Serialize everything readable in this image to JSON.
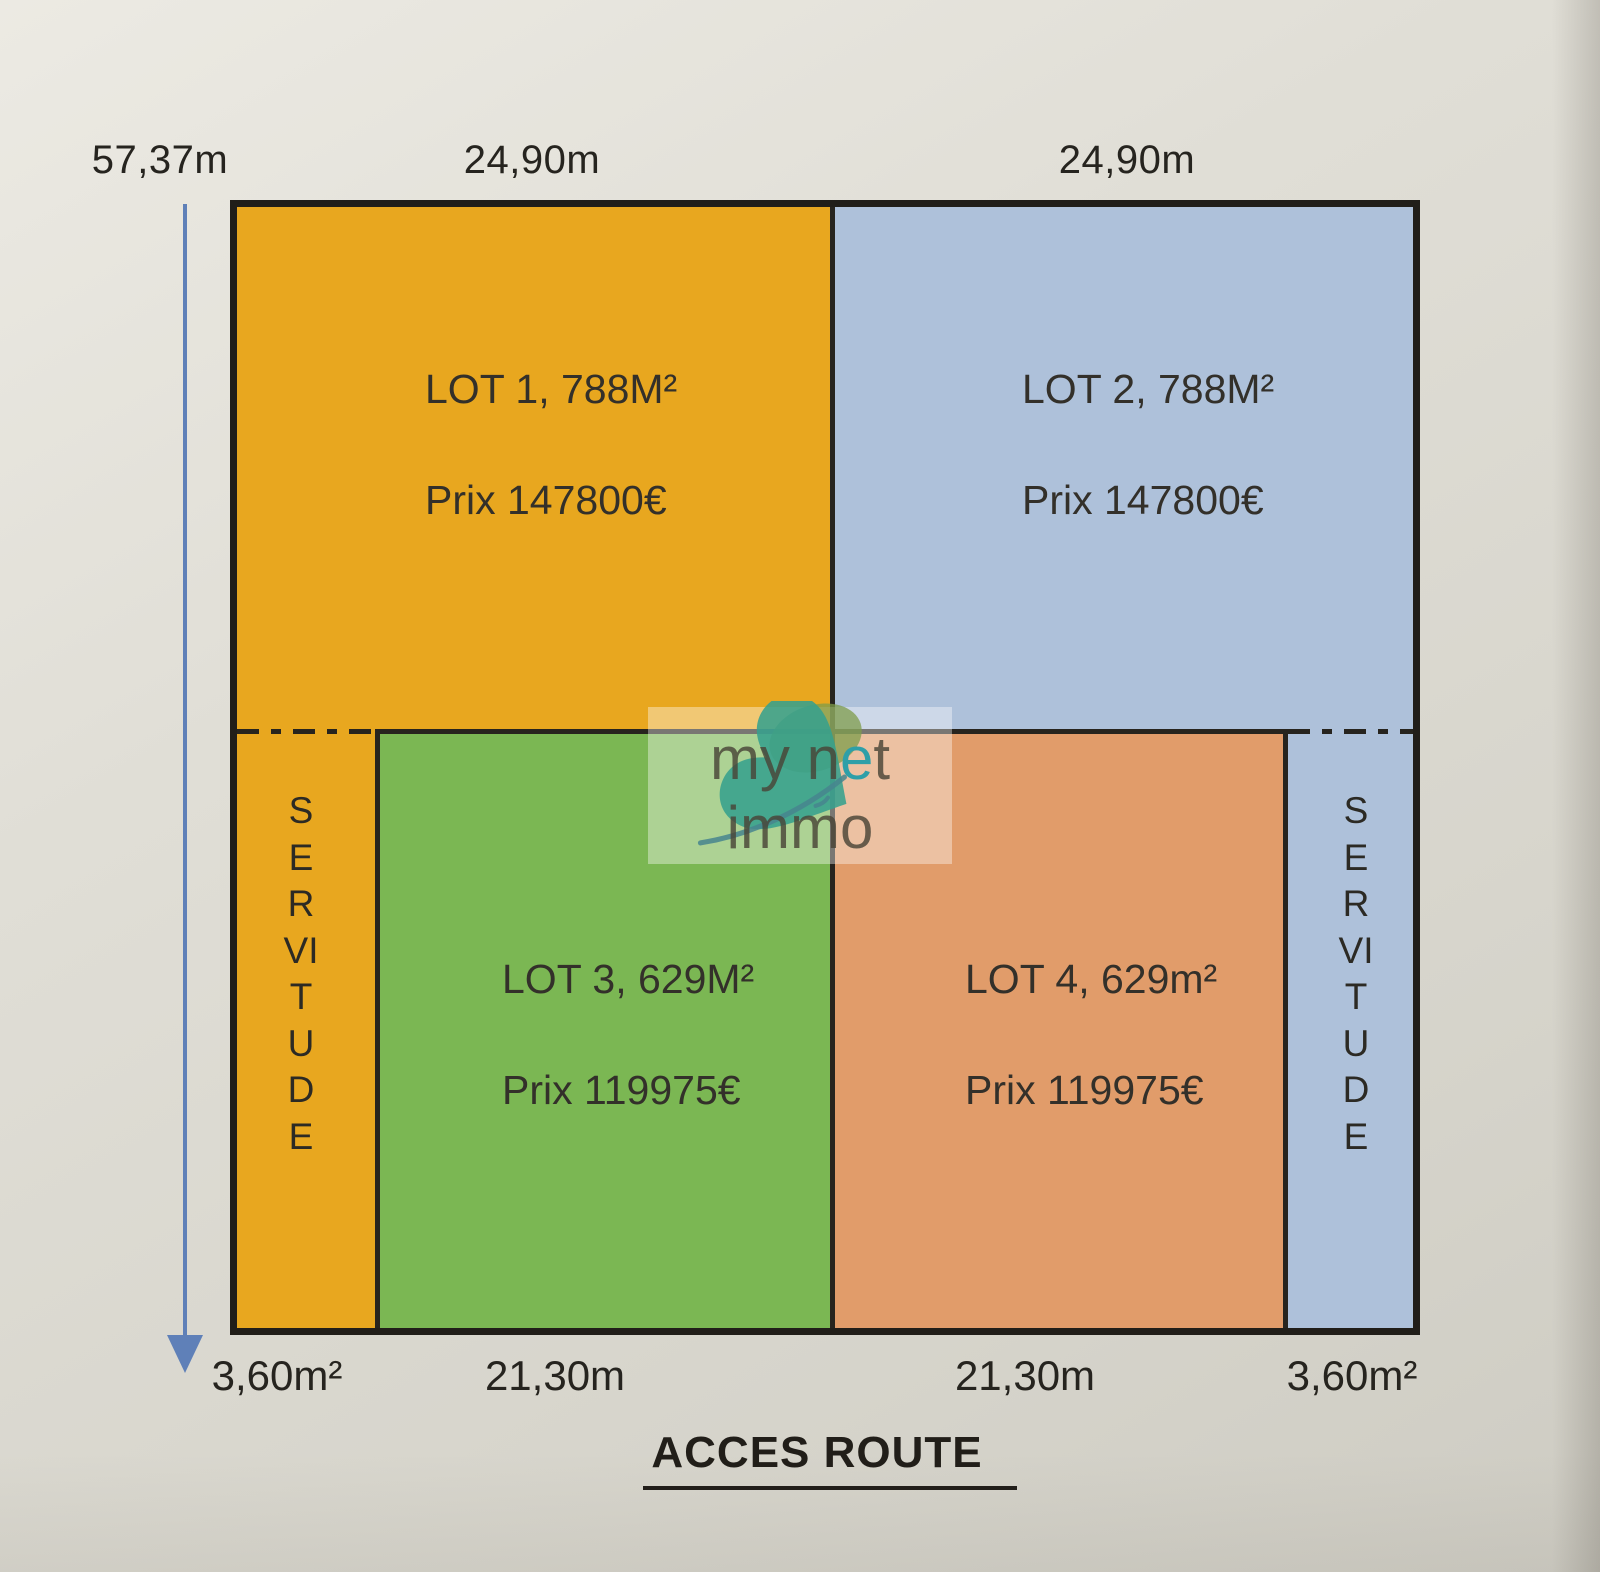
{
  "dimensions": {
    "height_label": "57,37m",
    "top_width_labels": [
      "24,90m",
      "24,90m"
    ],
    "bottom_labels": [
      "3,60m²",
      "21,30m",
      "21,30m",
      "3,60m²"
    ],
    "access_label": "ACCES ROUTE"
  },
  "lots": [
    {
      "title": "LOT 1, 788M²",
      "price": "Prix 147800€",
      "color": "#e8a71f"
    },
    {
      "title": "LOT 2, 788M²",
      "price": "Prix 147800€",
      "color": "#aec1da"
    },
    {
      "title": "LOT 3, 629M²",
      "price": "Prix 119975€",
      "color": "#7bb753"
    },
    {
      "title": "LOT 4, 629m²",
      "price": "Prix 119975€",
      "color": "#e19c6a"
    }
  ],
  "servitude": {
    "left_label": "SERVITUDE",
    "right_label": "SERVITUDE"
  },
  "watermark": {
    "brand_part1": "my n",
    "brand_accent_letter": "e",
    "brand_part2": "t immo",
    "accent_color": "#2e9fa8",
    "butterfly_color": "#37a18d"
  },
  "colors": {
    "border": "#211e19",
    "arrow": "#5f80b8",
    "text": "#26241f"
  }
}
